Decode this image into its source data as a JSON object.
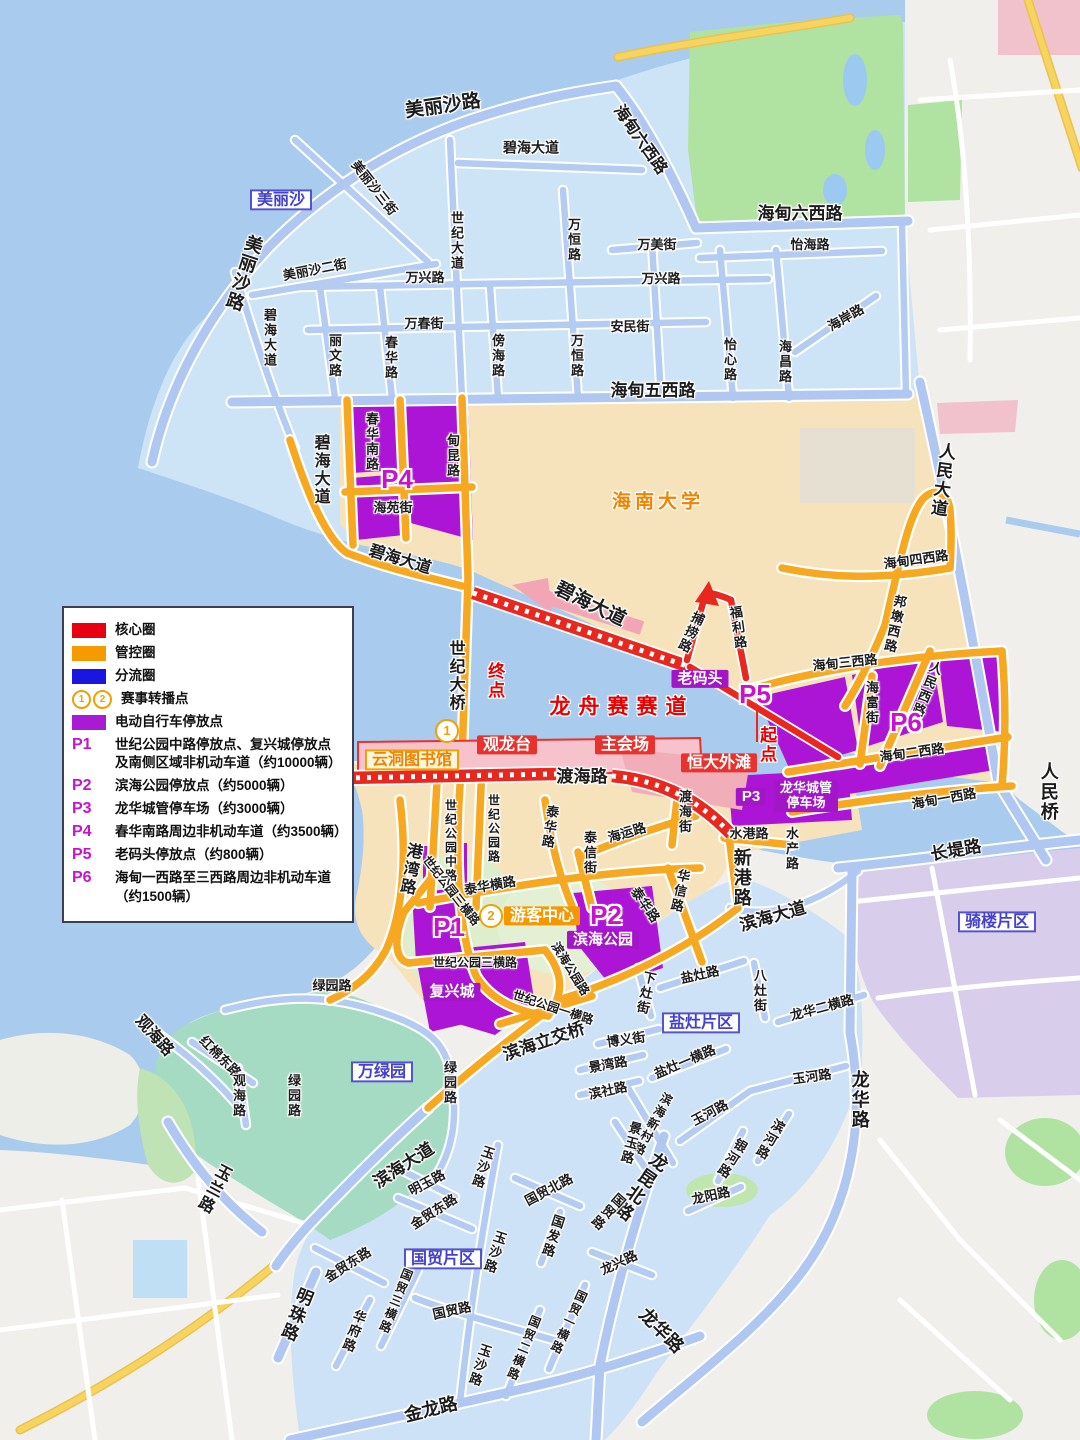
{
  "palette": {
    "sea": "#A8CBEE",
    "island_zone": "#CDE4F7",
    "beige_zone": "#F6E3BB",
    "gray_land": "#F0EFEC",
    "teal_park": "#A5DBC3",
    "green_park": "#B0E2A2",
    "qilou_zone": "#D8CEEB",
    "parking_purple": "#AC14D6",
    "road_blue": "#B4CBF2",
    "road_orange": "#F7A821",
    "route_red": "#E8281E",
    "pink": "#F2A5B5",
    "road_yellow": "#F7D45E",
    "district_label_blue": "#4442CC"
  },
  "legend": {
    "items": [
      {
        "swatch": "#E60012",
        "text": "核心圈"
      },
      {
        "swatch": "#F59A00",
        "text": "管控圈"
      },
      {
        "swatch": "#1A16E0",
        "text": "分流圈"
      },
      {
        "circles": [
          "1",
          "2"
        ],
        "text": "赛事转播点"
      },
      {
        "swatch": "#A81AD4",
        "text": "电动自行车停放点"
      },
      {
        "code": "P1",
        "text": "世纪公园中路停放点、复兴城停放点",
        "text2": "及南侧区域非机动车道（约10000辆）"
      },
      {
        "code": "P2",
        "text": "滨海公园停放点（约5000辆）"
      },
      {
        "code": "P3",
        "text": "龙华城管停车场（约3000辆）"
      },
      {
        "code": "P4",
        "text": "春华南路周边非机动车道（约3500辆）"
      },
      {
        "code": "P5",
        "text": "老码头停放点（约800辆）"
      },
      {
        "code": "P6",
        "text": "海甸一西路至三西路周边非机动车道",
        "text2": "（约1500辆）"
      }
    ]
  },
  "map": {
    "labels": [
      {
        "t": "美丽沙路",
        "x": 443,
        "y": 107,
        "c": "rdb",
        "r": -8,
        "fs": 19
      },
      {
        "t": "海甸六西路",
        "x": 640,
        "y": 140,
        "c": "rdb",
        "r": 55,
        "fs": 16
      },
      {
        "t": "美丽沙三街",
        "x": 374,
        "y": 188,
        "c": "rd",
        "r": 52
      },
      {
        "t": "美丽沙",
        "x": 281,
        "y": 200,
        "c": "bxb"
      },
      {
        "t": "碧海大道",
        "x": 531,
        "y": 148,
        "c": "rd",
        "fs": 14
      },
      {
        "t": "美丽沙路",
        "x": 243,
        "y": 273,
        "c": "rdb",
        "v": 1,
        "r": 18,
        "fs": 18
      },
      {
        "t": "美丽沙二街",
        "x": 315,
        "y": 270,
        "c": "rd",
        "r": -11
      },
      {
        "t": "万兴路",
        "x": 425,
        "y": 278,
        "c": "rd"
      },
      {
        "t": "世纪大道",
        "x": 456,
        "y": 241,
        "c": "rd",
        "v": 1
      },
      {
        "t": "万恒路",
        "x": 573,
        "y": 240,
        "c": "rd",
        "v": 1
      },
      {
        "t": "万美街",
        "x": 657,
        "y": 245,
        "c": "rd"
      },
      {
        "t": "万兴路",
        "x": 661,
        "y": 279,
        "c": "rd"
      },
      {
        "t": "怡海路",
        "x": 810,
        "y": 245,
        "c": "rd"
      },
      {
        "t": "万春街",
        "x": 424,
        "y": 324,
        "c": "rd"
      },
      {
        "t": "安民街",
        "x": 630,
        "y": 327,
        "c": "rd"
      },
      {
        "t": "碧海大道",
        "x": 269,
        "y": 338,
        "c": "rd",
        "v": 1
      },
      {
        "t": "丽文路",
        "x": 334,
        "y": 356,
        "c": "rd",
        "v": 1
      },
      {
        "t": "春华路",
        "x": 390,
        "y": 358,
        "c": "rd",
        "v": 1
      },
      {
        "t": "傍海路",
        "x": 497,
        "y": 356,
        "c": "rd",
        "v": 1
      },
      {
        "t": "万恒路",
        "x": 576,
        "y": 356,
        "c": "rd",
        "v": 1
      },
      {
        "t": "怡心路",
        "x": 729,
        "y": 360,
        "c": "rd",
        "v": 1
      },
      {
        "t": "海昌路",
        "x": 784,
        "y": 362,
        "c": "rd",
        "v": 1
      },
      {
        "t": "海岸路",
        "x": 846,
        "y": 318,
        "c": "rd",
        "r": -30
      },
      {
        "t": "海甸六西路",
        "x": 800,
        "y": 214,
        "c": "rdb",
        "fs": 17
      },
      {
        "t": "海甸五西路",
        "x": 653,
        "y": 391,
        "c": "rdb",
        "fs": 17
      },
      {
        "t": "碧海大道",
        "x": 320,
        "y": 470,
        "c": "rdb",
        "v": 1,
        "fs": 16
      },
      {
        "t": "春华南路",
        "x": 371,
        "y": 442,
        "c": "rd",
        "v": 1
      },
      {
        "t": "甸昆路",
        "x": 452,
        "y": 456,
        "c": "rd",
        "v": 1
      },
      {
        "t": "P4",
        "x": 397,
        "y": 479,
        "c": "pm"
      },
      {
        "t": "海苑街",
        "x": 393,
        "y": 508,
        "c": "rd"
      },
      {
        "t": "碧海大道",
        "x": 400,
        "y": 560,
        "c": "rdb",
        "r": 17,
        "fs": 16
      },
      {
        "t": "海南大学",
        "x": 658,
        "y": 503,
        "c": "uni"
      },
      {
        "t": "世纪大桥",
        "x": 455,
        "y": 676,
        "c": "rdb",
        "v": 1,
        "fs": 16
      },
      {
        "t": "终点",
        "x": 494,
        "y": 681,
        "c": "redt",
        "v": 1
      },
      {
        "t": "碧海大道",
        "x": 590,
        "y": 605,
        "c": "rdb",
        "r": 26,
        "fs": 19
      },
      {
        "t": "人民大道",
        "x": 941,
        "y": 480,
        "c": "rdb",
        "v": 1,
        "r": 8,
        "fs": 17
      },
      {
        "t": "海甸四西路",
        "x": 916,
        "y": 560,
        "c": "rd",
        "r": -8
      },
      {
        "t": "邦墩西路",
        "x": 894,
        "y": 624,
        "c": "rd",
        "v": 1,
        "r": 12
      },
      {
        "t": "海甸三西路",
        "x": 845,
        "y": 663,
        "c": "rd",
        "r": -6
      },
      {
        "t": "捕捞路",
        "x": 690,
        "y": 632,
        "c": "rd",
        "v": 1,
        "r": 25
      },
      {
        "t": "福利路",
        "x": 737,
        "y": 628,
        "c": "rd",
        "v": 1,
        "r": -8
      },
      {
        "t": "老码头",
        "x": 700,
        "y": 679,
        "c": "bxp"
      },
      {
        "t": "P5",
        "x": 755,
        "y": 694,
        "c": "pm"
      },
      {
        "t": "起点",
        "x": 766,
        "y": 745,
        "c": "redt",
        "v": 1
      },
      {
        "t": "龙舟赛赛道",
        "x": 622,
        "y": 708,
        "c": "race",
        "ls": 8
      },
      {
        "t": "海富街",
        "x": 871,
        "y": 703,
        "c": "rd",
        "v": 1
      },
      {
        "t": "人民西路",
        "x": 926,
        "y": 689,
        "c": "rd",
        "v": 1,
        "r": 22
      },
      {
        "t": "P6",
        "x": 906,
        "y": 722,
        "c": "pm"
      },
      {
        "t": "海甸二西路",
        "x": 912,
        "y": 753,
        "c": "rd",
        "r": -8
      },
      {
        "t": "海甸一西路",
        "x": 944,
        "y": 799,
        "c": "rd",
        "r": -10
      },
      {
        "t": "人民桥",
        "x": 1048,
        "y": 792,
        "c": "rdb",
        "v": 1,
        "fs": 18
      },
      {
        "t": "长堤路",
        "x": 956,
        "y": 851,
        "c": "rdb",
        "r": -10,
        "fs": 17
      },
      {
        "t": "渡海路",
        "x": 582,
        "y": 777,
        "c": "rdb",
        "fs": 17
      },
      {
        "t": "恒大外滩",
        "x": 719,
        "y": 763,
        "c": "bxr"
      },
      {
        "t": "观龙台",
        "x": 507,
        "y": 745,
        "c": "bxr"
      },
      {
        "t": "主会场",
        "x": 625,
        "y": 745,
        "c": "bxr"
      },
      {
        "t": "1",
        "x": 447,
        "y": 731,
        "c": "num"
      },
      {
        "t": "云洞图书馆",
        "x": 412,
        "y": 760,
        "c": "bxc"
      },
      {
        "t": "P3",
        "x": 751,
        "y": 797,
        "c": "bxp"
      },
      {
        "t": "龙华城管",
        "t2": "停车场",
        "x": 806,
        "y": 796,
        "c": "bxp2"
      },
      {
        "t": "水港路",
        "x": 749,
        "y": 834,
        "c": "rd"
      },
      {
        "t": "水产路",
        "x": 791,
        "y": 849,
        "c": "rd",
        "v": 1
      },
      {
        "t": "新港路",
        "x": 741,
        "y": 878,
        "c": "rdb",
        "v": 1,
        "fs": 18
      },
      {
        "t": "渡海街",
        "x": 684,
        "y": 812,
        "c": "rd",
        "v": 1
      },
      {
        "t": "海运路",
        "x": 627,
        "y": 833,
        "c": "rd",
        "r": -16
      },
      {
        "t": "泰华路",
        "x": 549,
        "y": 827,
        "c": "rd",
        "v": 1,
        "r": 8
      },
      {
        "t": "泰信街",
        "x": 589,
        "y": 853,
        "c": "rd",
        "v": 1
      },
      {
        "t": "华信路",
        "x": 679,
        "y": 891,
        "c": "rd",
        "v": 1,
        "r": 12
      },
      {
        "t": "泰华横路",
        "x": 490,
        "y": 886,
        "c": "rd",
        "r": -10
      },
      {
        "t": "世纪公园中路",
        "x": 450,
        "y": 841,
        "c": "rd",
        "v": 1,
        "fs": 12
      },
      {
        "t": "世纪公园路",
        "x": 493,
        "y": 829,
        "c": "rd",
        "v": 1,
        "fs": 12
      },
      {
        "t": "港湾路",
        "x": 409,
        "y": 869,
        "c": "rdb",
        "v": 1,
        "r": 10,
        "fs": 16
      },
      {
        "t": "世纪公园三横路",
        "x": 451,
        "y": 891,
        "c": "rd",
        "r": 52,
        "fs": 12
      },
      {
        "t": "P1",
        "x": 449,
        "y": 927,
        "c": "pm"
      },
      {
        "t": "2",
        "x": 491,
        "y": 916,
        "c": "num"
      },
      {
        "t": "游客中心",
        "x": 542,
        "y": 916,
        "c": "bxo"
      },
      {
        "t": "P2",
        "x": 606,
        "y": 915,
        "c": "pm"
      },
      {
        "t": "滨海公园",
        "x": 603,
        "y": 940,
        "c": "bxp"
      },
      {
        "t": "泰华路",
        "x": 645,
        "y": 905,
        "c": "rd",
        "r": 55
      },
      {
        "t": "世纪公园三横路",
        "x": 475,
        "y": 963,
        "c": "rd",
        "fs": 12
      },
      {
        "t": "复兴城",
        "x": 452,
        "y": 992,
        "c": "bxp"
      },
      {
        "t": "滨海公园路",
        "x": 570,
        "y": 969,
        "c": "rd",
        "r": 58,
        "fs": 12
      },
      {
        "t": "世纪公园一横路",
        "x": 553,
        "y": 1008,
        "c": "rd",
        "r": 18,
        "fs": 12
      },
      {
        "t": "滨海立交桥",
        "x": 544,
        "y": 1042,
        "c": "rdb",
        "r": -19,
        "fs": 17
      },
      {
        "t": "绿园路",
        "x": 332,
        "y": 986,
        "c": "rd"
      },
      {
        "t": "盐灶路",
        "x": 700,
        "y": 975,
        "c": "rd",
        "r": -12
      },
      {
        "t": "下灶街",
        "x": 645,
        "y": 993,
        "c": "rd",
        "v": 1,
        "r": 12
      },
      {
        "t": "八灶街",
        "x": 759,
        "y": 991,
        "c": "rd",
        "v": 1
      },
      {
        "t": "龙华二横路",
        "x": 822,
        "y": 1008,
        "c": "rd",
        "r": -15
      },
      {
        "t": "盐灶片区",
        "x": 701,
        "y": 1023,
        "c": "bxb"
      },
      {
        "t": "博义街",
        "x": 626,
        "y": 1040,
        "c": "rd",
        "r": -8
      },
      {
        "t": "盐灶一横路",
        "x": 685,
        "y": 1062,
        "c": "rd",
        "r": -23
      },
      {
        "t": "玉河路",
        "x": 812,
        "y": 1077,
        "c": "rd",
        "r": -8
      },
      {
        "t": "景湾路",
        "x": 608,
        "y": 1065,
        "c": "rd",
        "r": -10
      },
      {
        "t": "滨社路",
        "x": 608,
        "y": 1091,
        "c": "rd",
        "r": -12
      },
      {
        "t": "滨海新村路",
        "x": 652,
        "y": 1124,
        "c": "rd",
        "v": 1,
        "r": 28,
        "fs": 12
      },
      {
        "t": "玉河路",
        "x": 710,
        "y": 1113,
        "c": "rd",
        "r": -28
      },
      {
        "t": "景玉路",
        "x": 630,
        "y": 1143,
        "c": "rd",
        "v": 1,
        "r": 15
      },
      {
        "t": "银河路",
        "x": 731,
        "y": 1158,
        "c": "rd",
        "v": 1,
        "r": 32
      },
      {
        "t": "滨河路",
        "x": 769,
        "y": 1139,
        "c": "rd",
        "v": 1,
        "r": 30
      },
      {
        "t": "龙华路",
        "x": 859,
        "y": 1100,
        "c": "rdb",
        "v": 1,
        "fs": 18
      },
      {
        "t": "龙昆北路",
        "x": 640,
        "y": 1186,
        "c": "rdb",
        "v": 1,
        "r": 35,
        "fs": 18
      },
      {
        "t": "国贸路",
        "x": 607,
        "y": 1211,
        "c": "rd",
        "v": 1,
        "r": 42
      },
      {
        "t": "龙阳路",
        "x": 711,
        "y": 1196,
        "c": "rd",
        "r": -12
      },
      {
        "t": "龙兴路",
        "x": 619,
        "y": 1263,
        "c": "rd",
        "r": -25
      },
      {
        "t": "骑楼片区",
        "x": 997,
        "y": 922,
        "c": "bxb"
      },
      {
        "t": "滨海大道",
        "x": 773,
        "y": 917,
        "c": "rdb",
        "r": -16,
        "fs": 17
      },
      {
        "t": "玉沙路",
        "x": 482,
        "y": 1167,
        "c": "rd",
        "v": 1,
        "r": 18
      },
      {
        "t": "国贸北路",
        "x": 549,
        "y": 1190,
        "c": "rd",
        "r": -28
      },
      {
        "t": "国发路",
        "x": 552,
        "y": 1236,
        "c": "rd",
        "v": 1,
        "r": 18
      },
      {
        "t": "滨海大道",
        "x": 404,
        "y": 1166,
        "c": "rdb",
        "r": -33,
        "fs": 17
      },
      {
        "t": "明玉路",
        "x": 427,
        "y": 1183,
        "c": "rd",
        "r": -28
      },
      {
        "t": "金贸东路",
        "x": 434,
        "y": 1212,
        "c": "rd",
        "r": -33
      },
      {
        "t": "金贸东路",
        "x": 348,
        "y": 1265,
        "c": "rd",
        "r": -33
      },
      {
        "t": "国贸片区",
        "x": 443,
        "y": 1259,
        "c": "bxb"
      },
      {
        "t": "国贸路",
        "x": 452,
        "y": 1311,
        "c": "rd",
        "r": -12
      },
      {
        "t": "国贸三横路",
        "x": 395,
        "y": 1301,
        "c": "rd",
        "v": 1,
        "r": 22,
        "fs": 12
      },
      {
        "t": "华府路",
        "x": 353,
        "y": 1331,
        "c": "rd",
        "v": 1,
        "r": 20
      },
      {
        "t": "明珠路",
        "x": 295,
        "y": 1314,
        "c": "rdb",
        "v": 1,
        "r": 22,
        "fs": 17
      },
      {
        "t": "玉沙路",
        "x": 494,
        "y": 1252,
        "c": "rd",
        "v": 1,
        "r": 18
      },
      {
        "t": "玉沙路",
        "x": 479,
        "y": 1365,
        "c": "rd",
        "v": 1,
        "r": 18
      },
      {
        "t": "国贸二横路",
        "x": 523,
        "y": 1348,
        "c": "rd",
        "v": 1,
        "r": 22,
        "fs": 12
      },
      {
        "t": "国贸一横路",
        "x": 568,
        "y": 1322,
        "c": "rd",
        "v": 1,
        "r": 25,
        "fs": 12
      },
      {
        "t": "金龙路",
        "x": 431,
        "y": 1410,
        "c": "rdb",
        "r": -14,
        "fs": 18
      },
      {
        "t": "龙华路",
        "x": 661,
        "y": 1331,
        "c": "rdb",
        "r": 45,
        "fs": 18
      },
      {
        "t": "万绿园",
        "x": 382,
        "y": 1072,
        "c": "bxb"
      },
      {
        "t": "绿园路",
        "x": 293,
        "y": 1096,
        "c": "rd",
        "v": 1
      },
      {
        "t": "绿园路",
        "x": 449,
        "y": 1083,
        "c": "rd",
        "v": 1
      },
      {
        "t": "观海路",
        "x": 154,
        "y": 1036,
        "c": "rdb",
        "r": 48,
        "fs": 16
      },
      {
        "t": "红棉东路",
        "x": 220,
        "y": 1057,
        "c": "rd",
        "r": 45
      },
      {
        "t": "观海路",
        "x": 238,
        "y": 1096,
        "c": "rd",
        "v": 1
      },
      {
        "t": "玉兰路",
        "x": 213,
        "y": 1188,
        "c": "rdb",
        "v": 1,
        "r": 28,
        "fs": 16
      }
    ]
  }
}
